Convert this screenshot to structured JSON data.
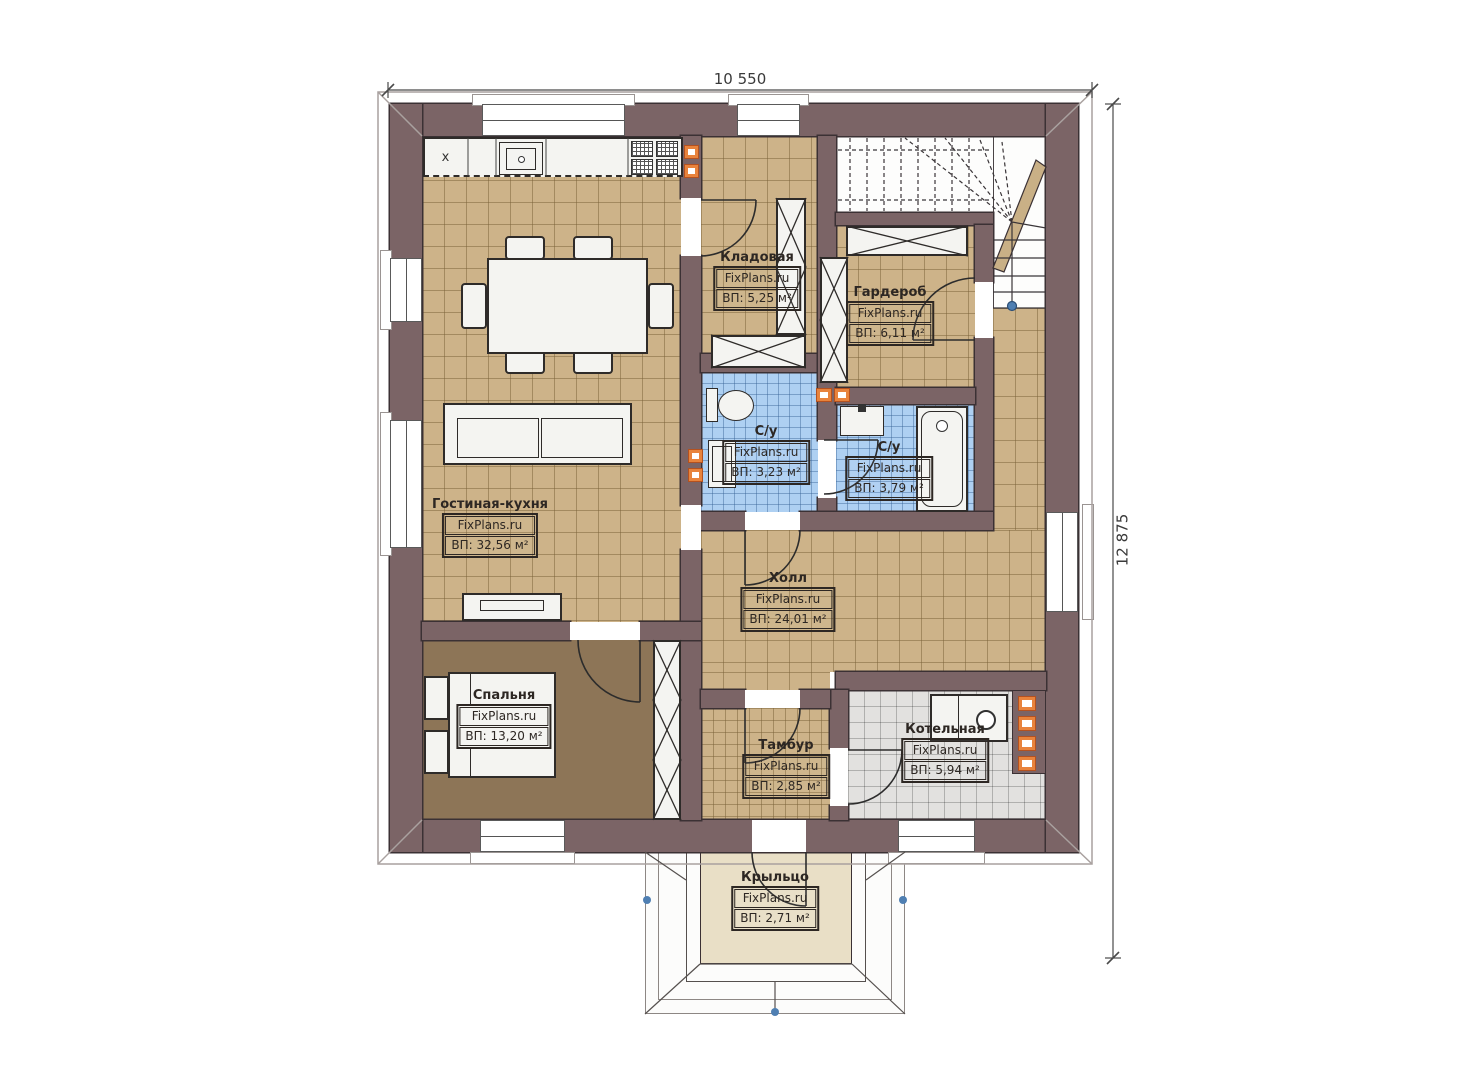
{
  "dimensions": {
    "top": "10 550",
    "right": "12 875"
  },
  "brand": "FixPlans.ru",
  "rooms": [
    {
      "id": "kladovaya",
      "name": "Кладовая",
      "brand": "FixPlans.ru",
      "area": "ВП: 5,25 м²"
    },
    {
      "id": "garderob",
      "name": "Гардероб",
      "brand": "FixPlans.ru",
      "area": "ВП: 6,11 м²"
    },
    {
      "id": "su-left",
      "name": "С/у",
      "brand": "FixPlans.ru",
      "area": "ВП: 3,23 м²"
    },
    {
      "id": "su-right",
      "name": "С/у",
      "brand": "FixPlans.ru",
      "area": "ВП: 3,79 м²"
    },
    {
      "id": "living-kitchen",
      "name": "Гостиная-кухня",
      "brand": "FixPlans.ru",
      "area": "ВП: 32,56 м²"
    },
    {
      "id": "hall",
      "name": "Холл",
      "brand": "FixPlans.ru",
      "area": "ВП: 24,01 м²"
    },
    {
      "id": "bedroom",
      "name": "Спальня",
      "brand": "FixPlans.ru",
      "area": "ВП: 13,20 м²"
    },
    {
      "id": "tambur",
      "name": "Тамбур",
      "brand": "FixPlans.ru",
      "area": "ВП: 2,85 м²"
    },
    {
      "id": "boiler",
      "name": "Котельная",
      "brand": "FixPlans.ru",
      "area": "ВП: 5,94 м²"
    },
    {
      "id": "porch",
      "name": "Крыльцо",
      "brand": "FixPlans.ru",
      "area": "ВП: 2,71 м²"
    }
  ],
  "annotations": {
    "kitchen_cabinet_mark": "x"
  },
  "colors": {
    "wall": "#7b6466",
    "floor_tan": "#cdb389",
    "floor_bedroom": "#8d7557",
    "floor_wet": "#aed0f2",
    "floor_boiler": "#e2e1df",
    "floor_porch": "#e9dfc6",
    "accent_orange": "#e8833c",
    "marker_blue": "#4f7fb2"
  }
}
